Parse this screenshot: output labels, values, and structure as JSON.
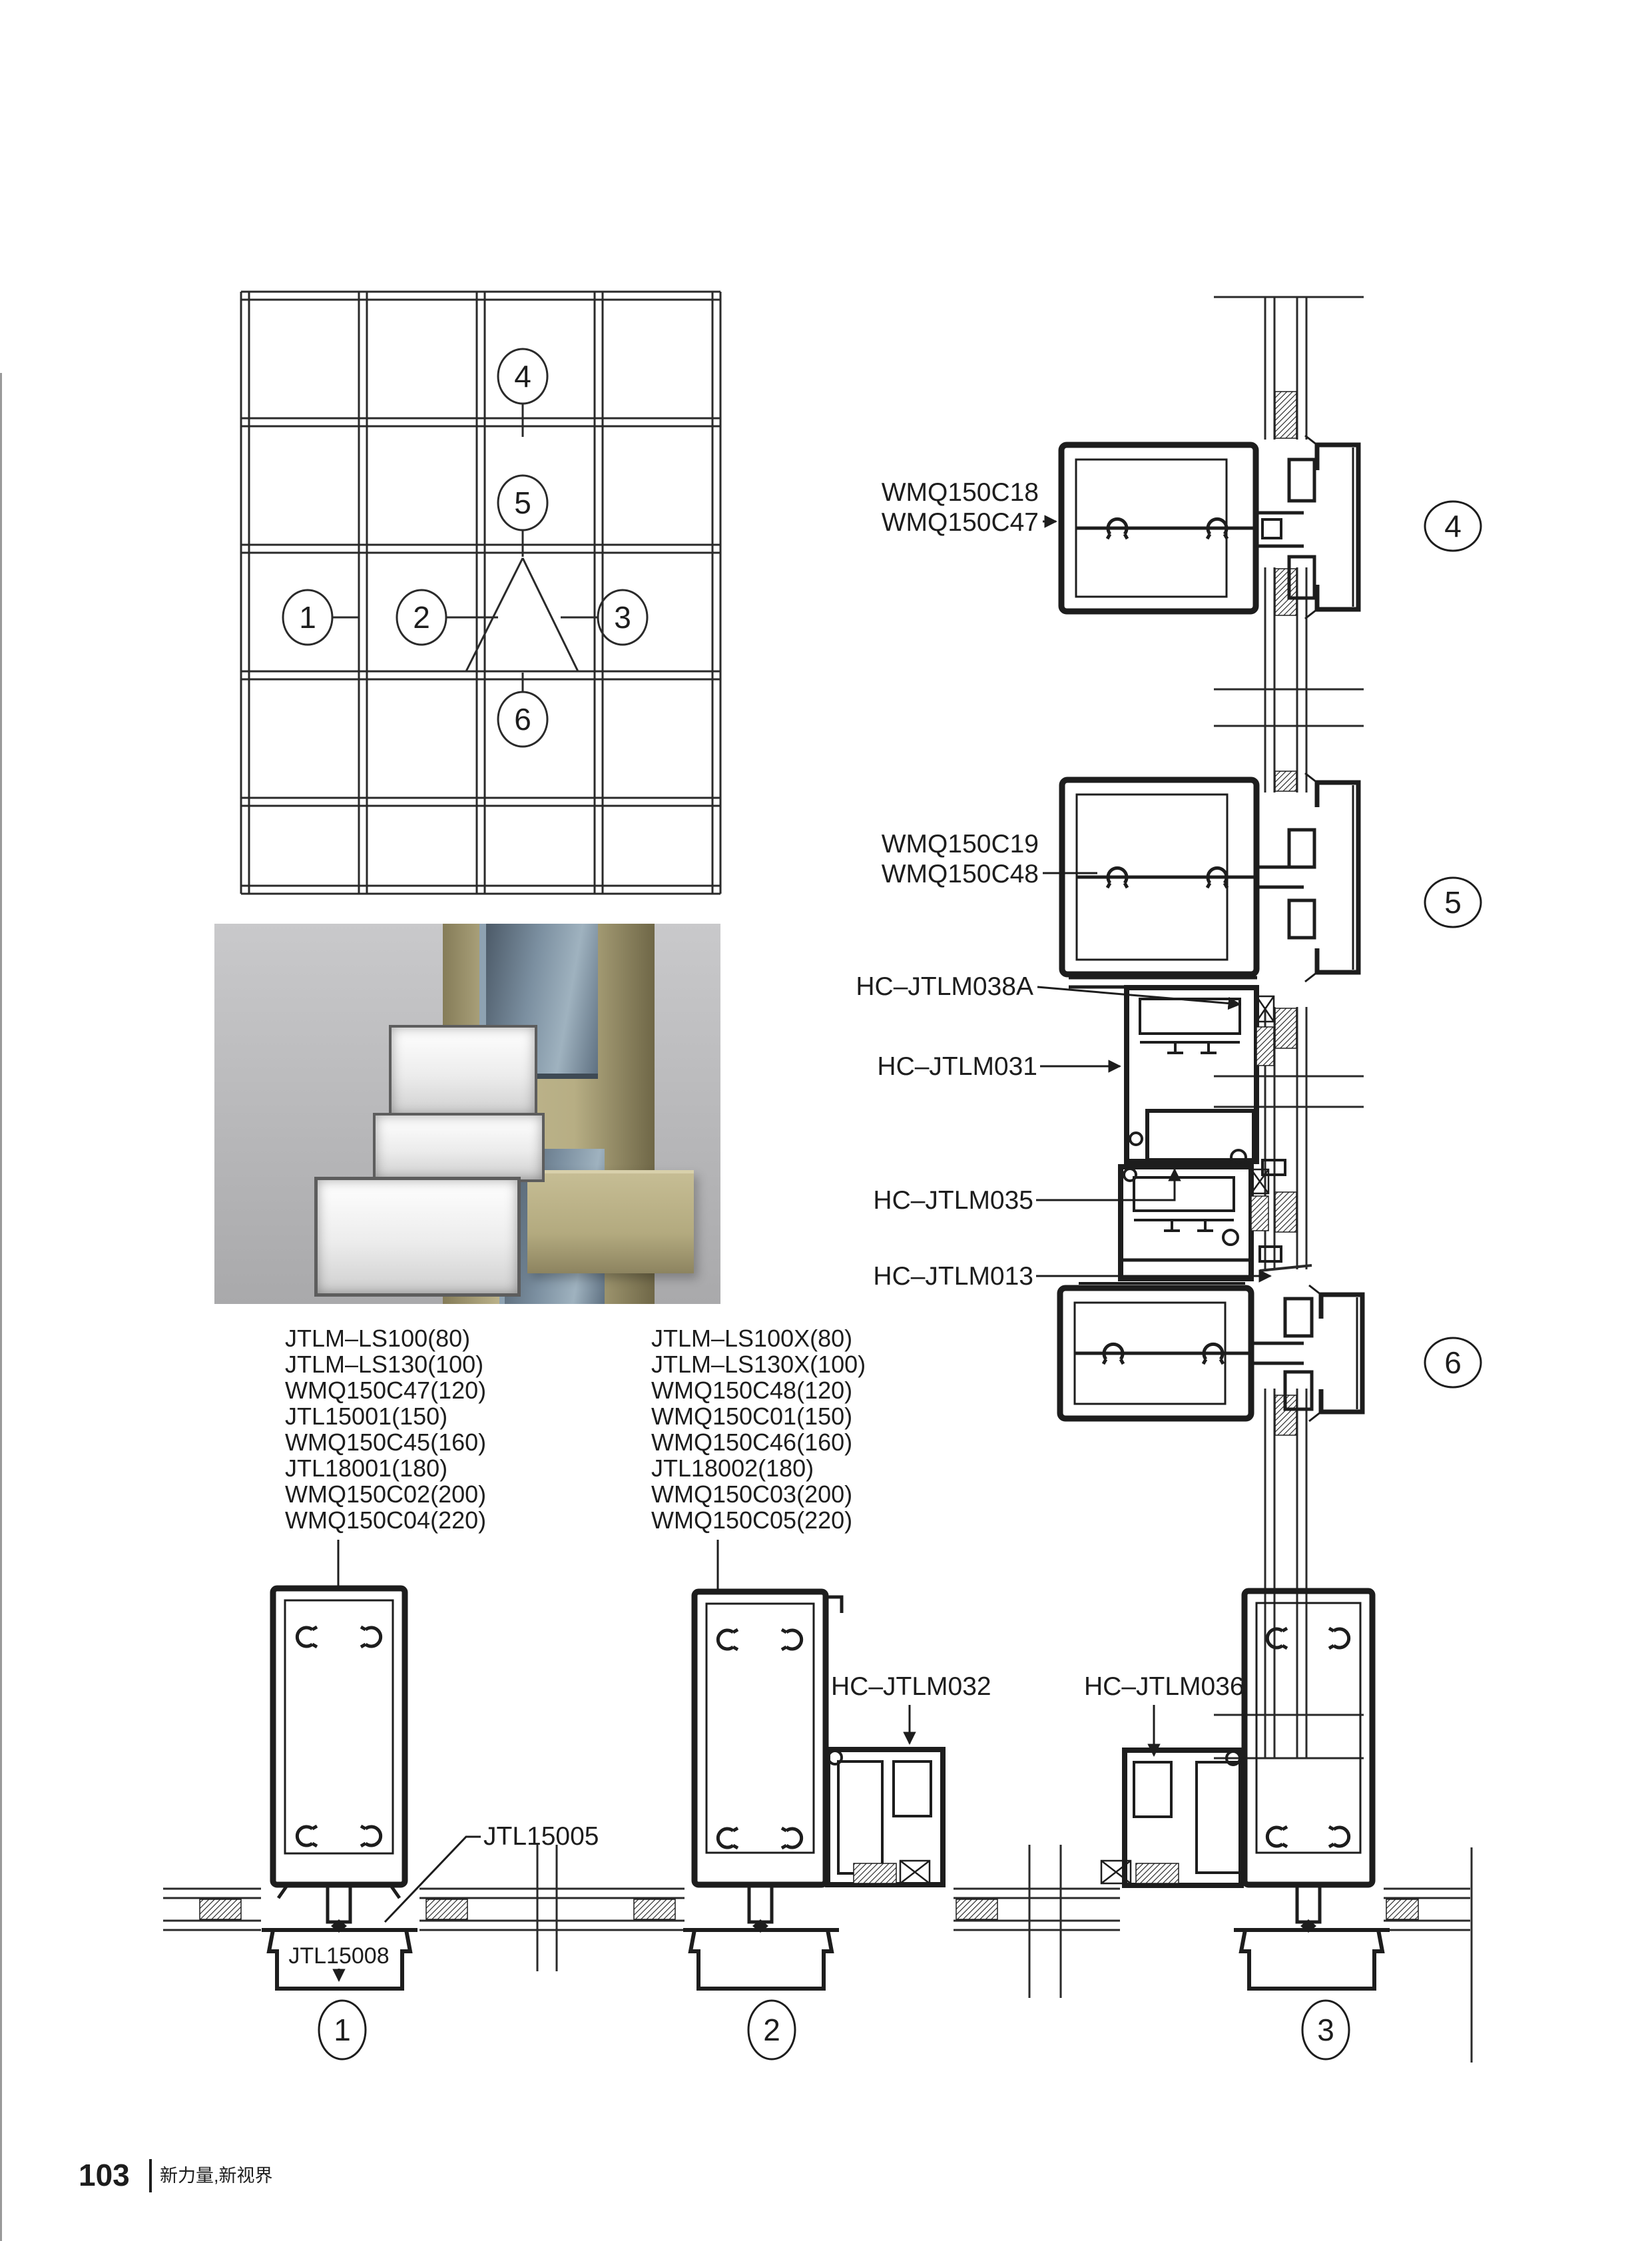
{
  "callouts": {
    "c1": "1",
    "c2": "2",
    "c3": "3",
    "c4": "4",
    "c5": "5",
    "c6": "6"
  },
  "detail4": {
    "labels": [
      "WMQ150C18",
      "WMQ150C47"
    ]
  },
  "detail5": {
    "labels": [
      "WMQ150C19",
      "WMQ150C48"
    ],
    "part_top": "HC–JTLM038A",
    "part_mid": "HC–JTLM031",
    "part_bottom": "HC–JTLM035"
  },
  "detail6": {
    "part": "HC–JTLM013"
  },
  "detail1": {
    "list": [
      "JTLM–LS100(80)",
      "JTLM–LS130(100)",
      "WMQ150C47(120)",
      "JTL15001(150)",
      "WMQ150C45(160)",
      "JTL18001(180)",
      "WMQ150C02(200)",
      "WMQ150C04(220)"
    ],
    "gasket": "JTL15005",
    "base_cover": "JTL15008"
  },
  "detail2": {
    "list": [
      "JTLM–LS100X(80)",
      "JTLM–LS130X(100)",
      "WMQ150C48(120)",
      "WMQ150C01(150)",
      "WMQ150C46(160)",
      "JTL18002(180)",
      "WMQ150C03(200)",
      "WMQ150C05(220)"
    ],
    "part": "HC–JTLM032"
  },
  "detail3": {
    "part": "HC–JTLM036"
  },
  "footer": {
    "page_number": "103",
    "tagline": "新力量,新视界"
  },
  "render_colors": {
    "background": "#b9b9bb",
    "frame_tan": "#b3aa7f",
    "glass_blue": "#7b8fa0",
    "aluminum_white": "#f2f2f2",
    "line_ink": "#1d1d1d"
  }
}
